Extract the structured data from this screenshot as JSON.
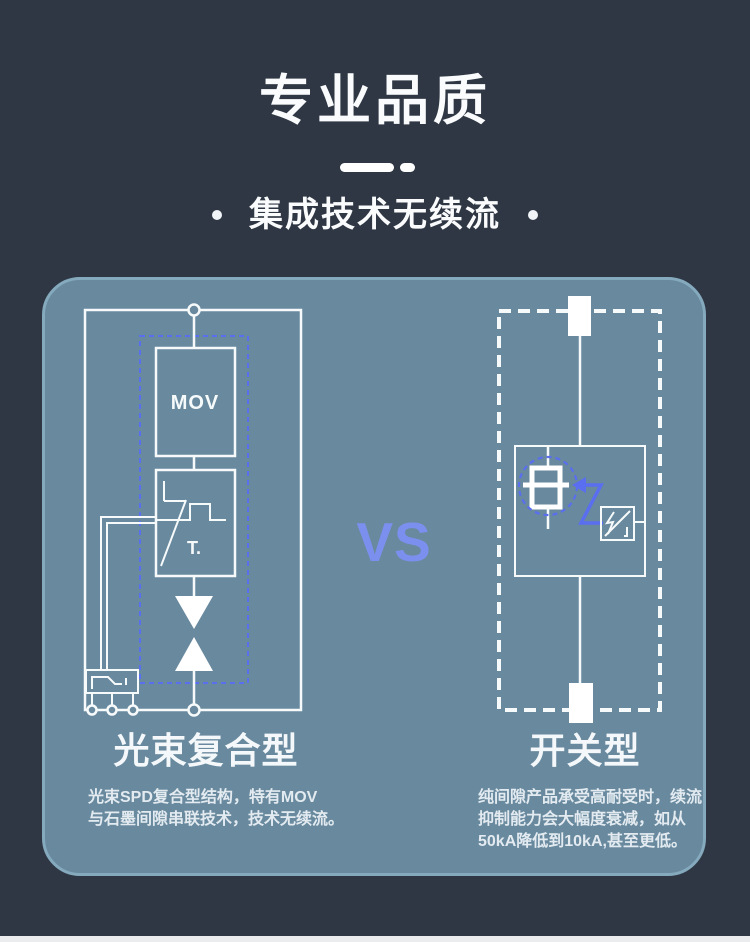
{
  "header": {
    "title": "专业品质",
    "subtitle": "集成技术无续流"
  },
  "comparison": {
    "vs_label": "VS",
    "left": {
      "heading": "光束复合型",
      "description": "光束SPD复合型结构，特有MOV\n与石墨间隙串联技术，技术无续流。",
      "labels": {
        "mov": "MOV",
        "trigger": "T."
      }
    },
    "right": {
      "heading": "开关型",
      "description": "纯间隙产品承受高耐受时，续流\n抑制能力会大幅度衰减，如从\n50kA降低到10kA,甚至更低。"
    }
  },
  "colors": {
    "background": "#2f3744",
    "panel_fill": "#68899e",
    "panel_border": "#85a9bd",
    "diagram_line": "#f7fafb",
    "accent_blue": "#5a6ef0",
    "vs_text": "#7b90ee"
  }
}
